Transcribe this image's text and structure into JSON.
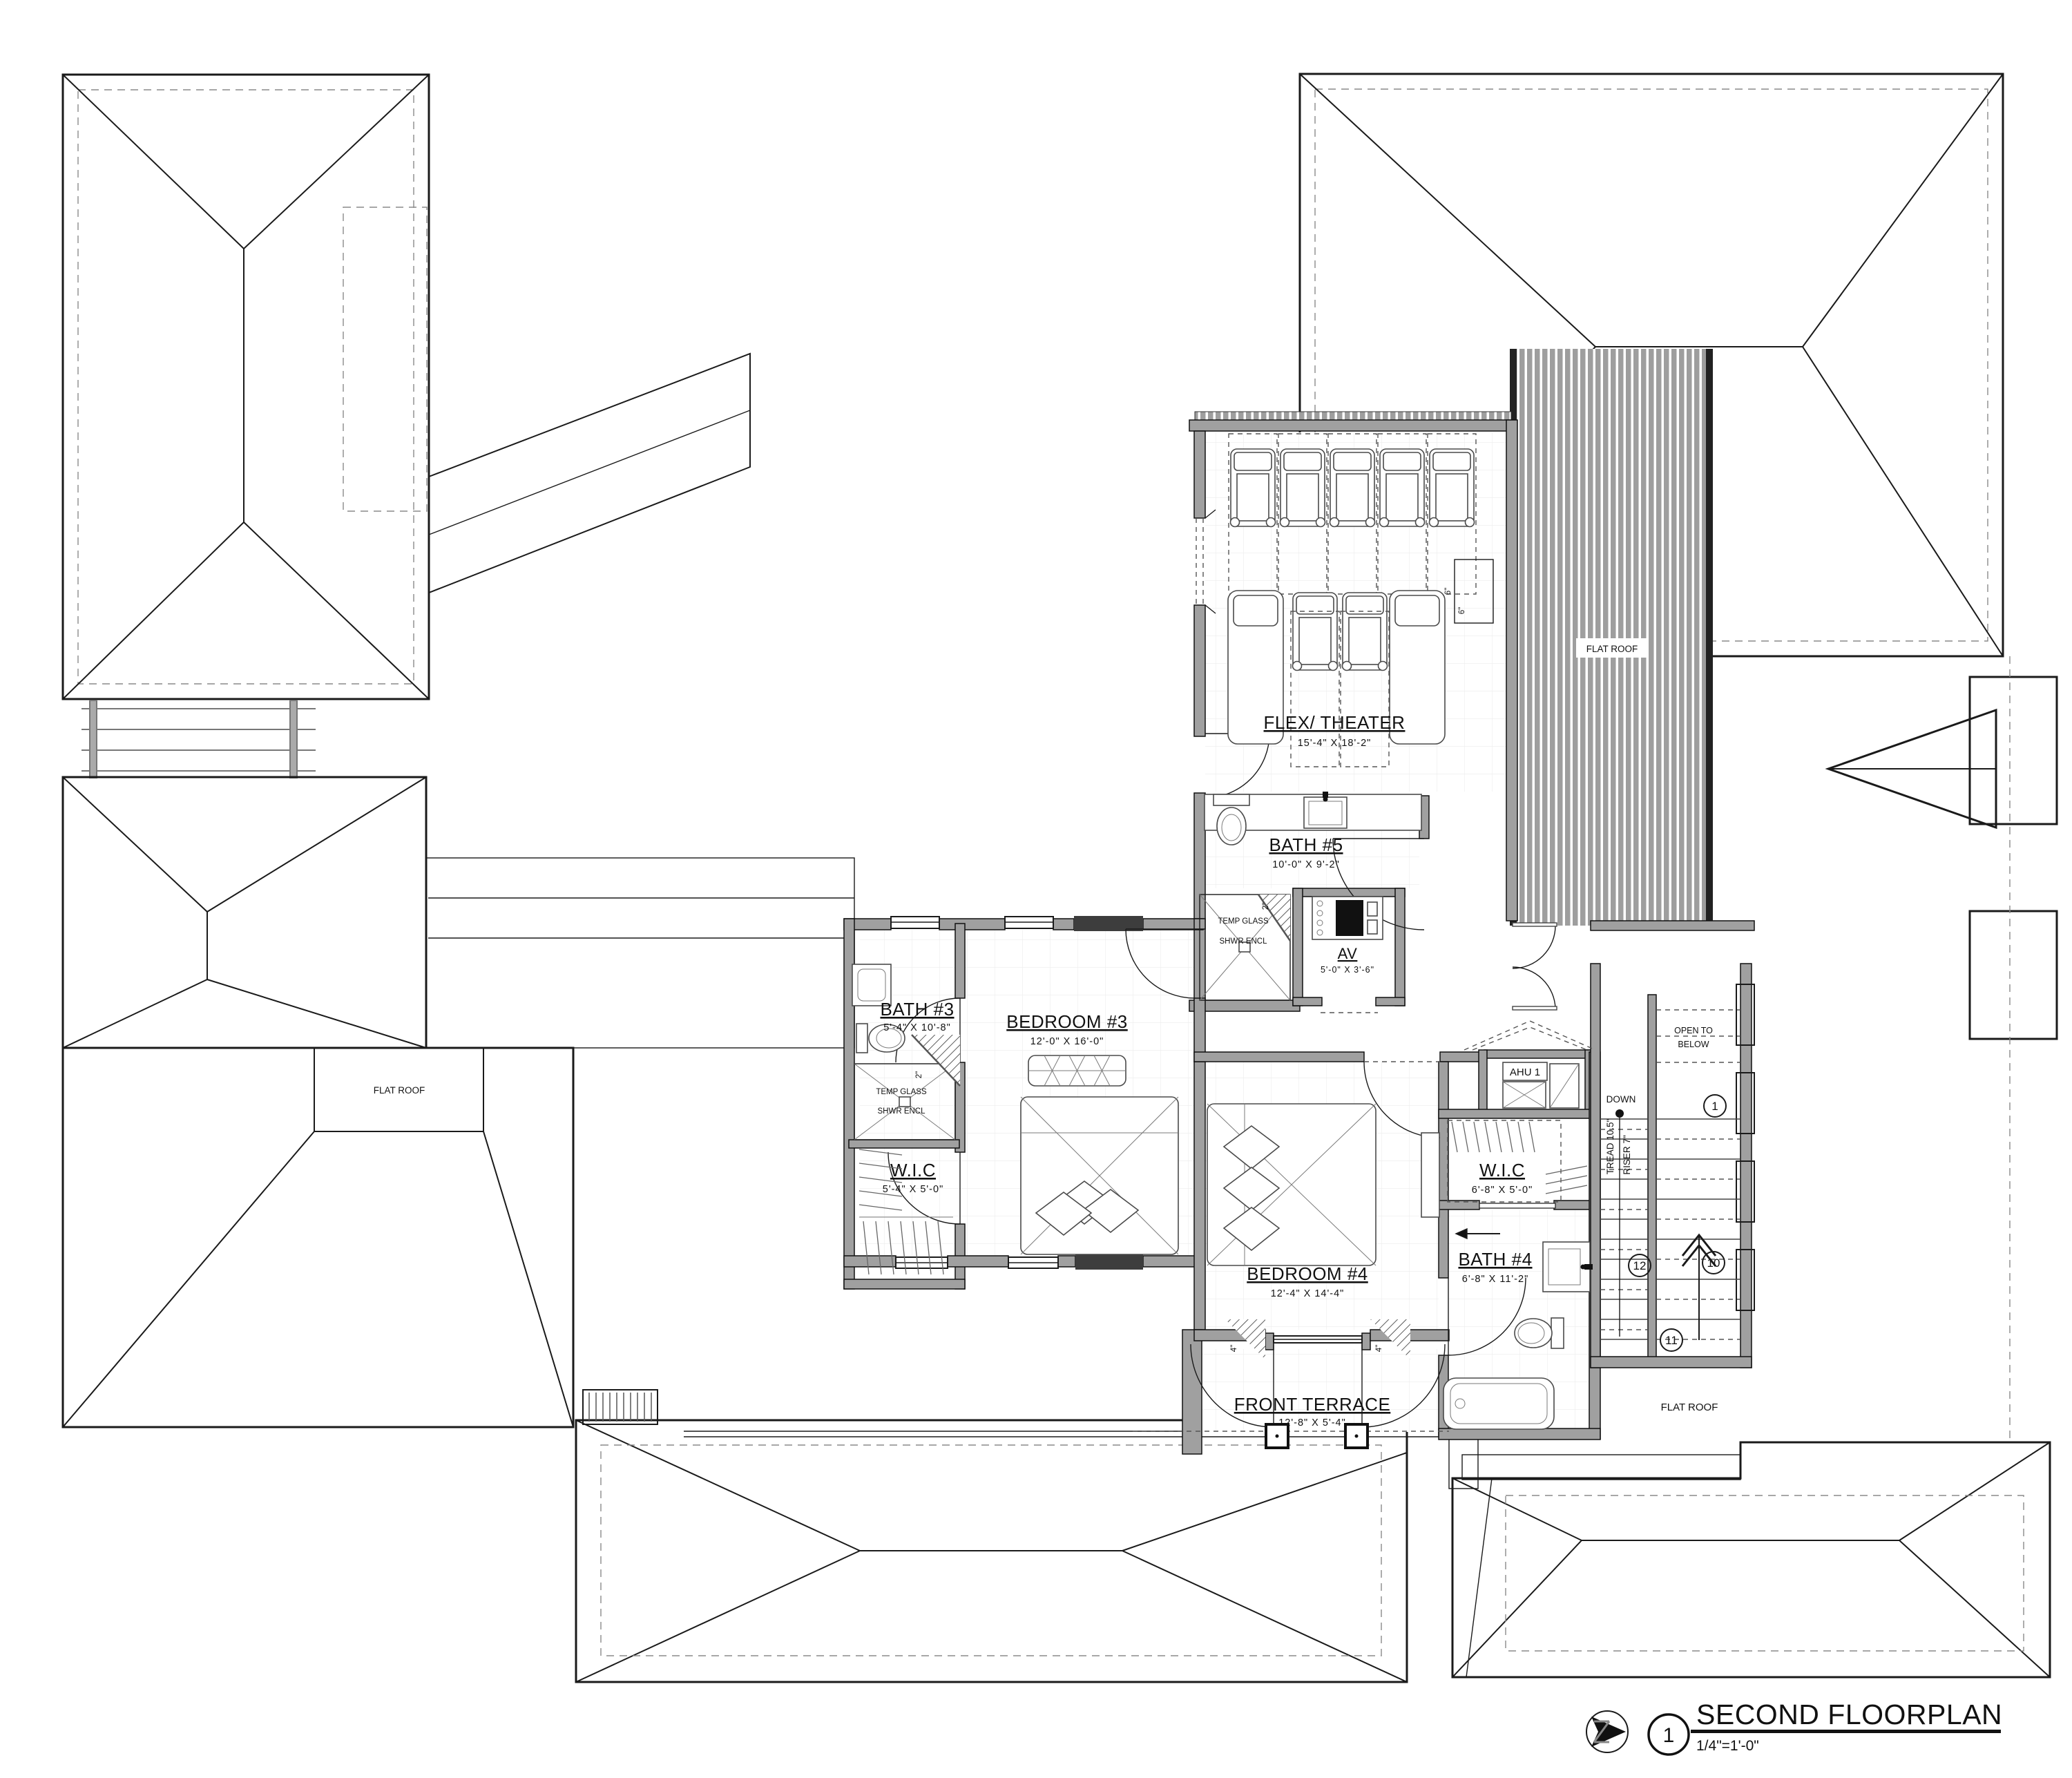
{
  "title_block": {
    "number": "1",
    "title": "SECOND FLOORPLAN",
    "scale": "1/4\"=1'-0\""
  },
  "rooms": {
    "flex_theater": {
      "name": "FLEX/ THEATER",
      "dims": "15'-4\"  X  18'-2\""
    },
    "bath5": {
      "name": "BATH #5",
      "dims": "10'-0\"  X  9'-2\""
    },
    "av": {
      "name": "AV",
      "dims": "5'-0\"  X  3'-6\""
    },
    "bath3": {
      "name": "BATH #3",
      "dims": "5'-4\"  X  10'-8\""
    },
    "bedroom3": {
      "name": "BEDROOM #3",
      "dims": "12'-0\"  X  16'-0\""
    },
    "wic_left": {
      "name": "W.I.C",
      "dims": "5'-4\"  X  5'-0\""
    },
    "bedroom4": {
      "name": "BEDROOM #4",
      "dims": "12'-4\"  X  14'-4\""
    },
    "wic_right": {
      "name": "W.I.C",
      "dims": "6'-8\"  X  5'-0\""
    },
    "bath4": {
      "name": "BATH #4",
      "dims": "6'-8\"  X  11'-2\""
    },
    "front_terrace": {
      "name": "FRONT TERRACE",
      "dims": "12'-8\"  X  5'-4\""
    }
  },
  "annotations": {
    "flat_roof": "FLAT ROOF",
    "open_to": "OPEN TO",
    "below": "BELOW",
    "down": "DOWN",
    "tread": "TREAD 10.5\"",
    "riser": "RISER 7\"",
    "ahu": "AHU 1",
    "temp_glass": "TEMP GLASS",
    "shwr_encl": "SHWR ENCL",
    "tag_2in": "2\"",
    "tag_4in": "4\"",
    "tag_6in": "6\""
  },
  "stair_markers": {
    "top": "1",
    "left": "12",
    "right": "10",
    "bottom": "11"
  },
  "colors": {
    "line": "#1a1a1a",
    "wall_fill": "#a0a0a0",
    "stripe_fill": "#9e9e9e",
    "hatch_fill": "#b9b9b9"
  }
}
